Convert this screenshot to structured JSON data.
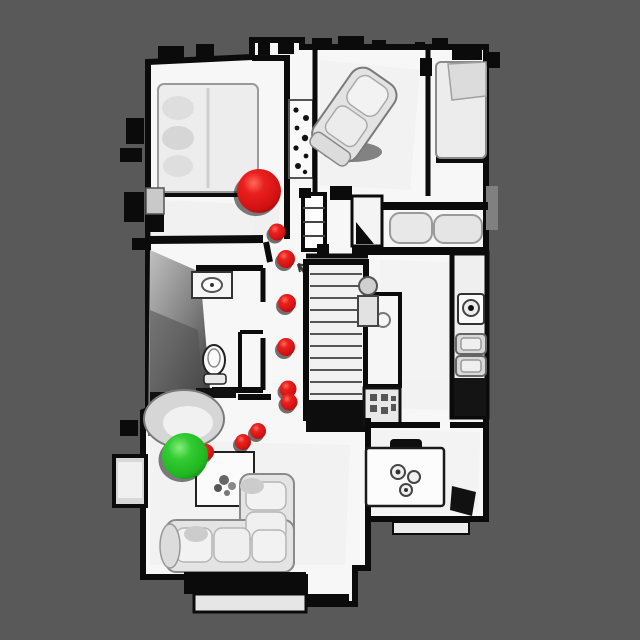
{
  "scene": {
    "description": "Top-down view of a scanned house interior with navigation path markers",
    "background_color": "#595959",
    "floor_color": "#f7f7f7",
    "wall_color": "#0b0b0b"
  },
  "markers": {
    "goal_sphere": {
      "x": 259,
      "y": 191,
      "r": 22,
      "color": "#e01818"
    },
    "agent_sphere": {
      "x": 185,
      "y": 456,
      "r": 23,
      "color": "#2dc92d"
    },
    "dot_color": "#d81414",
    "path_dots": [
      {
        "x": 277,
        "y": 232,
        "r": 8.5
      },
      {
        "x": 286,
        "y": 259,
        "r": 9
      },
      {
        "x": 287,
        "y": 303,
        "r": 9
      },
      {
        "x": 286,
        "y": 347,
        "r": 9
      },
      {
        "x": 288,
        "y": 389,
        "r": 8.5
      },
      {
        "x": 289,
        "y": 402,
        "r": 8.5
      },
      {
        "x": 258,
        "y": 431,
        "r": 8
      },
      {
        "x": 243,
        "y": 442,
        "r": 8
      },
      {
        "x": 206,
        "y": 452,
        "r": 8
      }
    ]
  }
}
